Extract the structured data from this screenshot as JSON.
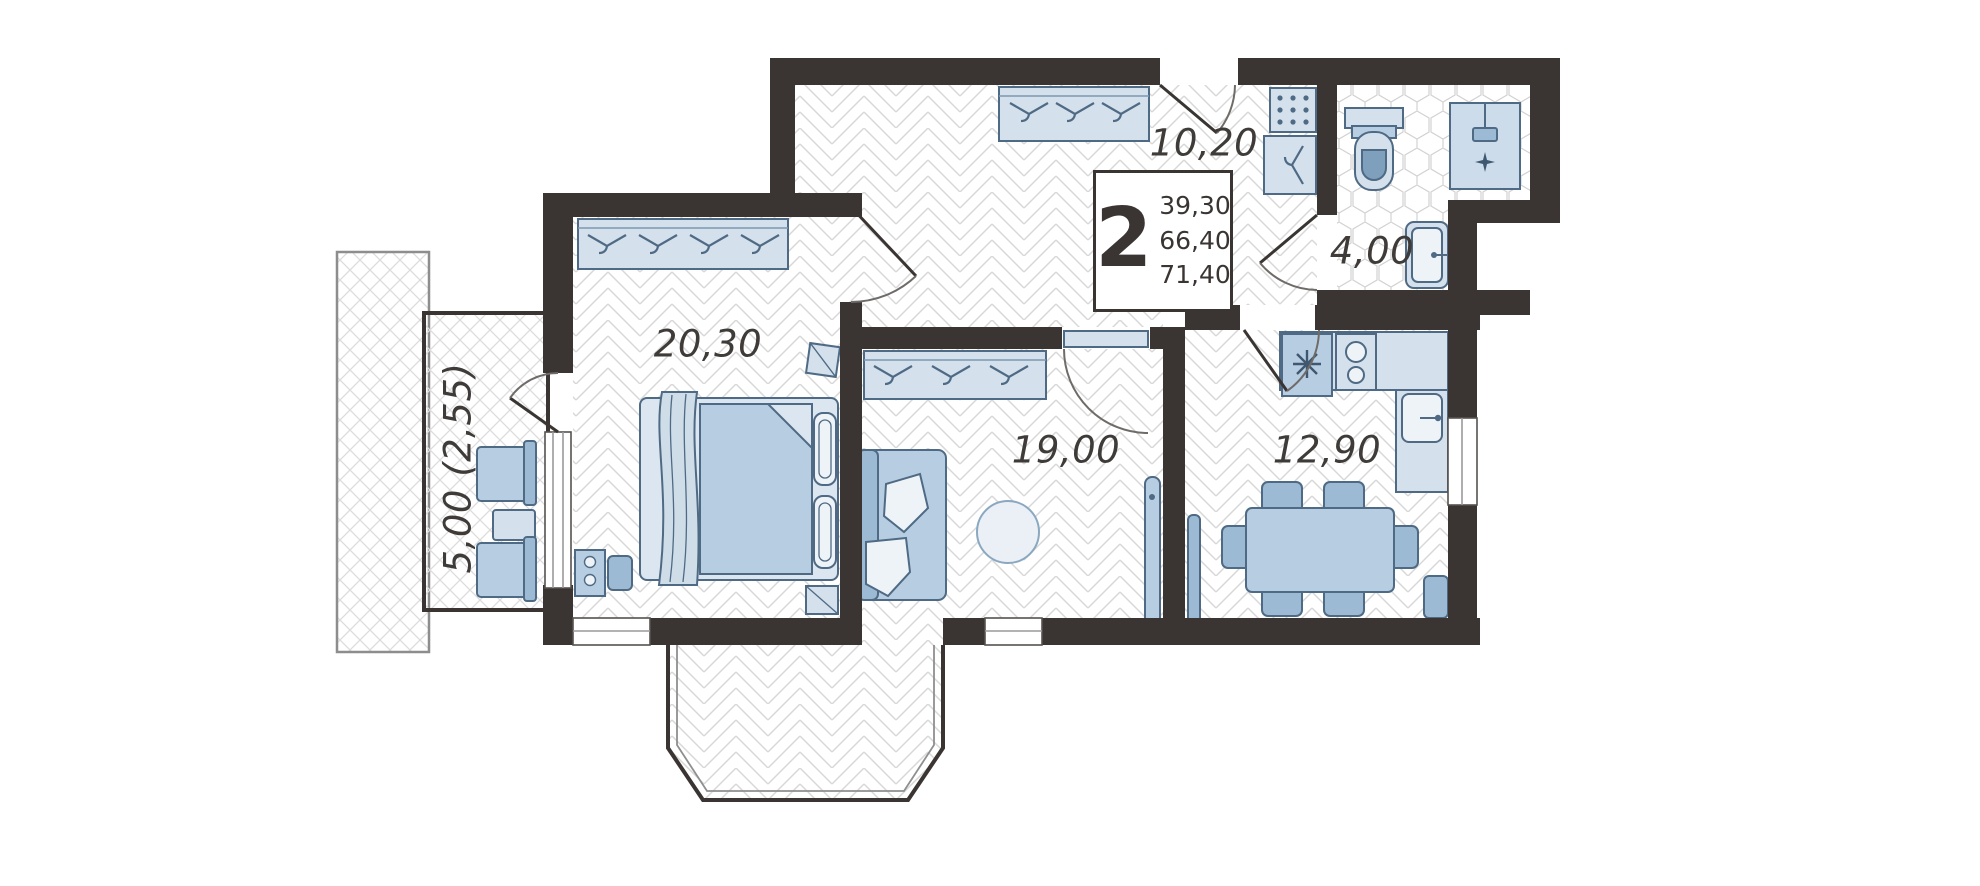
{
  "plan": {
    "title": "2-room apartment floor plan",
    "summary": {
      "rooms_count": "2",
      "values": [
        "39,30",
        "66,40",
        "71,40"
      ]
    },
    "rooms": [
      {
        "id": "bedroom",
        "area": "20,30"
      },
      {
        "id": "hallway",
        "area": "10,20"
      },
      {
        "id": "bathroom",
        "area": "4,00"
      },
      {
        "id": "living-room",
        "area": "19,00"
      },
      {
        "id": "kitchen",
        "area": "12,90"
      },
      {
        "id": "balcony",
        "area": "5,00 (2,55)"
      }
    ],
    "icons": {
      "hanger": "clothes-hanger glyph in wardrobes",
      "shower_sparkle": "4-point star on shower tray",
      "burner_star": "asterisk burner mark on kitchen unit",
      "grid_dots": "shoe-cabinet dot grid in hallway"
    },
    "palette": {
      "wall": "#3a3532",
      "furniture_fill": "#b7cee2",
      "furniture_light": "#d4e1ed",
      "furniture_dark": "#9cbad3",
      "furniture_stroke": "#4f6a84",
      "floor_line": "#d6d6d6",
      "label_text": "#3e3b39"
    }
  }
}
